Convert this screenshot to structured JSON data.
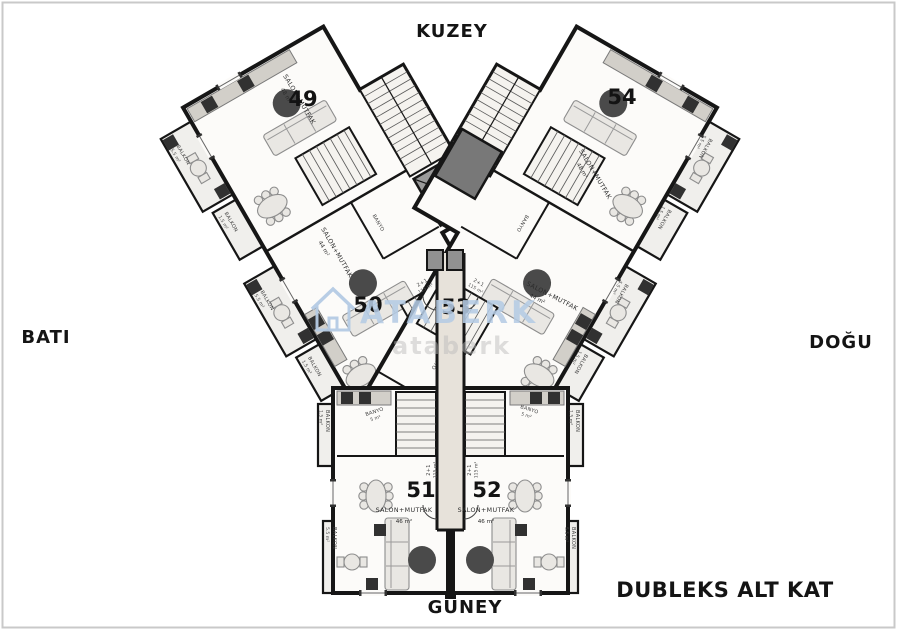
{
  "compass": {
    "north": "KUZEY",
    "south": "GÜNEY",
    "west": "BATI",
    "east": "DOĞU"
  },
  "plan": {
    "title": "DUBLEKS ALT KAT",
    "unit_type": "2+1",
    "unit_total_area": "115 m²"
  },
  "watermark": {
    "brand": "ATABERK",
    "secondary": "ataberk",
    "brand_color": "#b5cbe4"
  },
  "units": {
    "u49": {
      "number": "49",
      "room": "SALON+MUTFAK",
      "area": "48 m²"
    },
    "u50": {
      "number": "50",
      "room": "SALON+MUTFAK",
      "area": "44 m²"
    },
    "u51": {
      "number": "51",
      "room": "SALON+MUTFAK",
      "area": "46 m²"
    },
    "u52": {
      "number": "52",
      "room": "SALON+MUTFAK",
      "area": "46 m²"
    },
    "u53": {
      "number": "53",
      "room": "SALON+MUTFAK",
      "area": "44 m²"
    },
    "u54": {
      "number": "54",
      "room": "SALON+MUTFAK",
      "area": "48 m²"
    }
  },
  "rooms": {
    "balkon": "BALKON",
    "balkon_corner_area": "5.5 m²",
    "balkon_side_area": "1.5 m²",
    "banyo": "BANYO",
    "banyo_area": "5 m²"
  },
  "colors": {
    "wall": "#161616",
    "corridor": "#e7e2da",
    "elevator": "#9a9a9a"
  }
}
